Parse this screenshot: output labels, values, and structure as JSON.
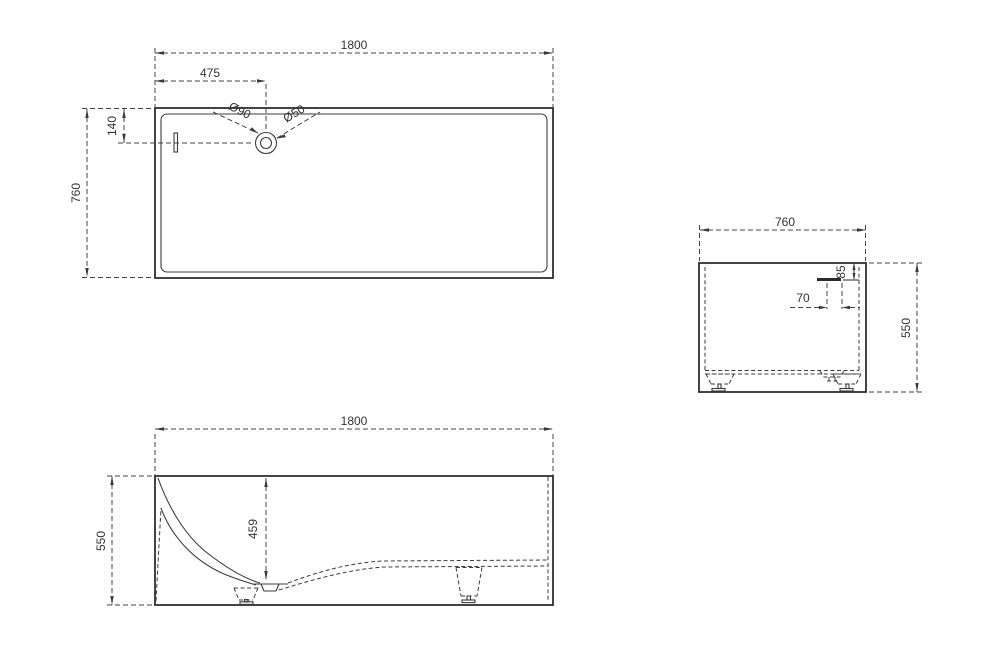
{
  "drawing": {
    "background": "#ffffff",
    "line_color": "#3a3a3a",
    "top_view": {
      "length": "1800",
      "drain_from_left": "475",
      "drain_from_edge": "140",
      "width": "760",
      "drain_outer_dia": "Ø90",
      "drain_inner_dia": "Ø50"
    },
    "end_view": {
      "width": "760",
      "height": "550",
      "overflow_offset": "70",
      "overflow_from_top": "85"
    },
    "side_view": {
      "length": "1800",
      "height": "550",
      "interior_depth": "459"
    }
  }
}
